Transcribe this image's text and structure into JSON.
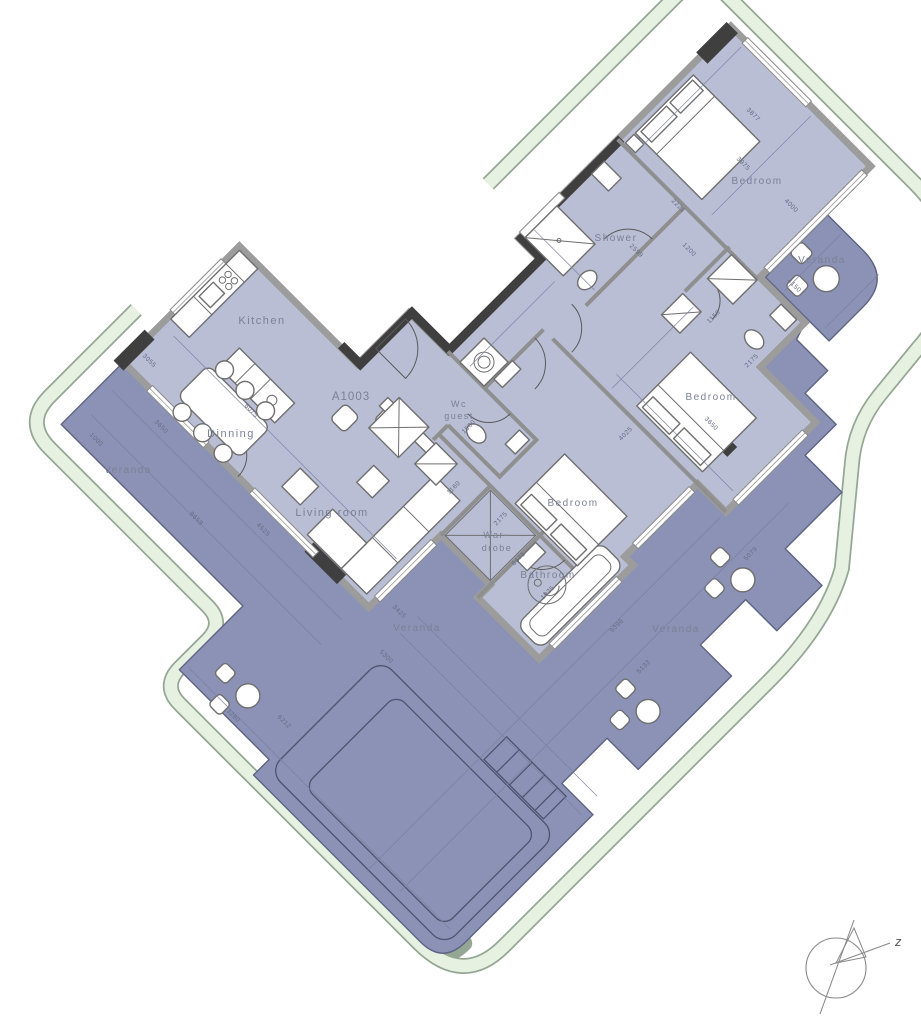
{
  "plan": {
    "unit_number": "A1003",
    "compass_label": "z"
  },
  "colors": {
    "room": "#b9bed4",
    "veranda": "#8b92b6",
    "wall": "#9c9c9c",
    "wallDark": "#3f3f3f",
    "innerWall": "#8f8f8f",
    "green": "#e6f1e1",
    "greenEdge": "#95a694",
    "outline": "#5d6382",
    "furnitureStroke": "#6f6f6f",
    "dimText": "#666b85",
    "labelText": "#7b8095",
    "thinLine": "#7b80a0"
  },
  "labels": [
    {
      "name": "label-kitchen",
      "text": "Kitchen",
      "x": 262,
      "y": 324,
      "size": 11
    },
    {
      "name": "label-dinning",
      "text": "Dinning",
      "x": 231,
      "y": 437,
      "size": 11
    },
    {
      "name": "label-living-room",
      "text": "Living room",
      "x": 332,
      "y": 516,
      "size": 11
    },
    {
      "name": "label-veranda-left",
      "text": "Veranda",
      "x": 128,
      "y": 473,
      "size": 10
    },
    {
      "name": "label-veranda-bottom-center",
      "text": "Veranda",
      "x": 417,
      "y": 631,
      "size": 10
    },
    {
      "name": "label-veranda-bottom-right",
      "text": "Veranda",
      "x": 676,
      "y": 632,
      "size": 10
    },
    {
      "name": "label-veranda-top-right",
      "text": "Veranda",
      "x": 822,
      "y": 263,
      "size": 10
    },
    {
      "name": "label-shower",
      "text": "Shower",
      "x": 616,
      "y": 241,
      "size": 10
    },
    {
      "name": "label-bedroom-top",
      "text": "Bedroom",
      "x": 757,
      "y": 184,
      "size": 10
    },
    {
      "name": "label-bedroom-right",
      "text": "Bedroom",
      "x": 711,
      "y": 400,
      "size": 10
    },
    {
      "name": "label-bedroom-bottom",
      "text": "Bedroom",
      "x": 573,
      "y": 506,
      "size": 10
    },
    {
      "name": "label-bathroom",
      "text": "Bathroom",
      "x": 548,
      "y": 578,
      "size": 10
    },
    {
      "name": "label-wc-line1",
      "text": "Wc",
      "x": 459,
      "y": 407,
      "size": 9
    },
    {
      "name": "label-wc-line2",
      "text": "guest",
      "x": 459,
      "y": 419,
      "size": 9
    },
    {
      "name": "label-wardrobe-line1",
      "text": "War−",
      "x": 497,
      "y": 538,
      "size": 9
    },
    {
      "name": "label-wardrobe-line2",
      "text": "drobe",
      "x": 497,
      "y": 551,
      "size": 9
    }
  ],
  "dimensions": [
    {
      "t": "3055",
      "x": 148,
      "y": 362,
      "r": 45
    },
    {
      "t": "3650",
      "x": 160,
      "y": 428,
      "r": 45
    },
    {
      "t": "1000",
      "x": 95,
      "y": 441,
      "r": 45
    },
    {
      "t": "8659",
      "x": 195,
      "y": 520,
      "r": 45
    },
    {
      "t": "6075",
      "x": 250,
      "y": 412,
      "r": 45
    },
    {
      "t": "4525",
      "x": 262,
      "y": 531,
      "r": 45
    },
    {
      "t": "3425",
      "x": 398,
      "y": 613,
      "r": 45
    },
    {
      "t": "5300",
      "x": 385,
      "y": 658,
      "r": 45
    },
    {
      "t": "3280",
      "x": 232,
      "y": 717,
      "r": 45
    },
    {
      "t": "6212",
      "x": 283,
      "y": 723,
      "r": 45
    },
    {
      "t": "1160",
      "x": 455,
      "y": 489,
      "r": -45
    },
    {
      "t": "2175",
      "x": 502,
      "y": 520,
      "r": -45
    },
    {
      "t": "8675",
      "x": 520,
      "y": 560,
      "r": -45
    },
    {
      "t": "1925",
      "x": 549,
      "y": 594,
      "r": -45
    },
    {
      "t": "9396",
      "x": 618,
      "y": 627,
      "r": -45
    },
    {
      "t": "5133",
      "x": 645,
      "y": 668,
      "r": -45
    },
    {
      "t": "5079",
      "x": 752,
      "y": 555,
      "r": -45
    },
    {
      "t": "4025",
      "x": 627,
      "y": 435,
      "r": -45
    },
    {
      "t": "1150",
      "x": 715,
      "y": 318,
      "r": -45
    },
    {
      "t": "2175",
      "x": 753,
      "y": 362,
      "r": -45
    },
    {
      "t": "3650",
      "x": 710,
      "y": 425,
      "r": 45
    },
    {
      "t": "3877",
      "x": 752,
      "y": 116,
      "r": 45
    },
    {
      "t": "3975",
      "x": 742,
      "y": 165,
      "r": 45
    },
    {
      "t": "4000",
      "x": 790,
      "y": 207,
      "r": 45
    },
    {
      "t": "4150",
      "x": 793,
      "y": 287,
      "r": 45
    },
    {
      "t": "2599",
      "x": 635,
      "y": 252,
      "r": 45
    },
    {
      "t": "2221",
      "x": 677,
      "y": 207,
      "r": 45
    },
    {
      "t": "1200",
      "x": 688,
      "y": 251,
      "r": 45
    },
    {
      "t": "1500",
      "x": 470,
      "y": 428,
      "r": -45
    }
  ]
}
